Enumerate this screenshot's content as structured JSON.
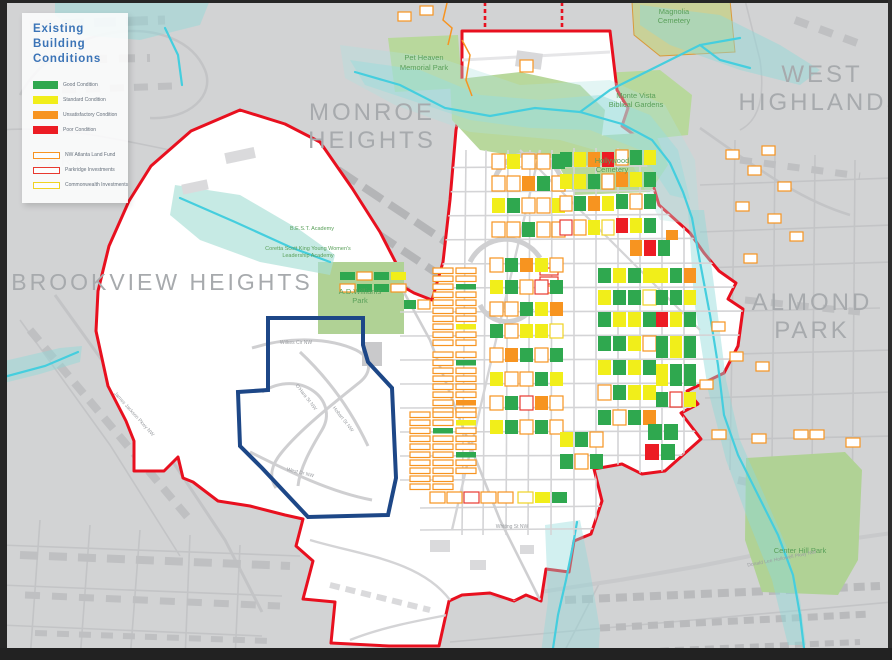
{
  "legend": {
    "title_lines": [
      "Existing",
      "Building",
      "Conditions"
    ],
    "condition_items": [
      {
        "label": "Good Condition",
        "color": "#2fa84f"
      },
      {
        "label": "Standard Condition",
        "color": "#f1ee1a"
      },
      {
        "label": "Unsatisfactory Condition",
        "color": "#f79420"
      },
      {
        "label": "Poor Condition",
        "color": "#ec1c24"
      }
    ],
    "ownership_items": [
      {
        "label": "NW Atlanta Land Fund",
        "outline": "#f79420"
      },
      {
        "label": "Parkridge Investments",
        "outline": "#e8392f"
      },
      {
        "label": "Commonwealth Investments",
        "outline": "#f0d322"
      }
    ]
  },
  "neighborhood_labels": {
    "monroe": {
      "line1": "MONROE",
      "line2": "HEIGHTS"
    },
    "west_highlands": {
      "line1": "WEST",
      "line2": "HIGHLANDS"
    },
    "brookview": {
      "line1": "BROOKVIEW HEIGHTS"
    },
    "almond": {
      "line1": "ALMOND",
      "line2": "PARK"
    },
    "park_partial": {
      "line1": "PARK"
    }
  },
  "park_labels": {
    "pet_heaven": {
      "line1": "Pet Heaven",
      "line2": "Memorial Park"
    },
    "magnolia": {
      "line1": "Magnolia",
      "line2": "Cemetery"
    },
    "monte_vista": {
      "line1": "Monte Vista",
      "line2": "Biblical Gardens"
    },
    "hollywood": {
      "line1": "Hollywood",
      "line2": "Cemetery"
    },
    "adw": {
      "line1": "A.D.Williams",
      "line2": "Park"
    },
    "center_hill": {
      "line1": "Center Hill Park"
    }
  },
  "school_labels": {
    "best": "B.E.S.T. Academy",
    "coretta1": "Coretta Scott King Young Women's",
    "coretta2": "Leadership Academy"
  },
  "street_labels": {
    "wilkes": "Wilkes Cir NW",
    "ohara": "O'Hara St NW",
    "hobart": "Hobart St NW",
    "west_dr": "West Dr NW",
    "whiting": "Whiting St NW",
    "dlh": "Donald Lee Hollowell Pkwy NW",
    "james_jackson": "James Jackson Pkwy NW"
  },
  "colors": {
    "map_background": "#d2d3d4",
    "study_area_fill": "#ffffff",
    "study_boundary_red": "#e8101f",
    "focus_outline_navy": "#1d4787",
    "park_green": "#b8d89c",
    "creek_cyan": "#45cede",
    "floodplain_teal": "#8fd9da",
    "neighborhood_label_gray": "#a7aaad",
    "park_label_green": "#5aa05a",
    "legend_title_blue": "#3b74b7"
  },
  "parcels": {
    "palette": {
      "g": {
        "fill": "#2fa84f"
      },
      "y": {
        "fill": "#f1ee1a"
      },
      "o": {
        "fill": "#f79420"
      },
      "r": {
        "fill": "#ec1c24"
      },
      "w": {
        "fill": "#ffffff",
        "stroke": "#f79420"
      },
      "p": {
        "fill": "#ffffff",
        "stroke": "#e8392f"
      },
      "c": {
        "fill": "#ffffff",
        "stroke": "#f0d322"
      },
      "b": {
        "fill": "#ffffff",
        "stroke": "#bdbdbf"
      }
    },
    "blocks": [
      {
        "x": 433,
        "y": 268,
        "cw": 20,
        "ch": 5.5,
        "gy": 2.5,
        "dir": "v",
        "cells": "wwwwwwwwww"
      },
      {
        "x": 456,
        "y": 268,
        "cw": 20,
        "ch": 5.5,
        "gy": 2.5,
        "dir": "v",
        "cells": "wwgwwwwyww"
      },
      {
        "x": 433,
        "y": 352,
        "cw": 20,
        "ch": 5.5,
        "gy": 2.5,
        "dir": "v",
        "cells": "wwwwwwww"
      },
      {
        "x": 456,
        "y": 352,
        "cw": 20,
        "ch": 5.5,
        "gy": 2.5,
        "dir": "v",
        "cells": "wgwwwwow"
      },
      {
        "x": 410,
        "y": 412,
        "cw": 20,
        "ch": 5.5,
        "gy": 2.5,
        "dir": "v",
        "cells": "wwwwwwwwww"
      },
      {
        "x": 433,
        "y": 412,
        "cw": 20,
        "ch": 5.5,
        "gy": 2.5,
        "dir": "v",
        "cells": "wwgwwwwwww"
      },
      {
        "x": 456,
        "y": 412,
        "cw": 20,
        "ch": 5.5,
        "gy": 2.5,
        "dir": "v",
        "cells": "wywwwgww"
      },
      {
        "x": 340,
        "y": 272,
        "cw": 15,
        "ch": 8,
        "dir": "h",
        "cells": "gwgy"
      },
      {
        "x": 340,
        "y": 284,
        "cw": 15,
        "ch": 8,
        "dir": "h",
        "cells": "wggw"
      },
      {
        "x": 404,
        "y": 300,
        "cw": 12,
        "ch": 9,
        "dir": "h",
        "cells": "gw"
      },
      {
        "x": 492,
        "y": 154,
        "cw": 13,
        "ch": 15,
        "dir": "h",
        "cells": "wywwg"
      },
      {
        "x": 492,
        "y": 176,
        "cw": 13,
        "ch": 15,
        "dir": "h",
        "cells": "wwogw"
      },
      {
        "x": 492,
        "y": 198,
        "cw": 13,
        "ch": 15,
        "dir": "h",
        "cells": "ygwwy"
      },
      {
        "x": 492,
        "y": 222,
        "cw": 13,
        "ch": 15,
        "dir": "h",
        "cells": "wwgww"
      },
      {
        "x": 560,
        "y": 152,
        "cw": 12,
        "ch": 15,
        "dir": "h",
        "cells": "gyor"
      },
      {
        "x": 560,
        "y": 174,
        "cw": 12,
        "ch": 15,
        "dir": "h",
        "cells": "yygw"
      },
      {
        "x": 560,
        "y": 196,
        "cw": 12,
        "ch": 15,
        "dir": "h",
        "cells": "wgoy"
      },
      {
        "x": 616,
        "y": 150,
        "cw": 12,
        "ch": 15,
        "dir": "h",
        "cells": "wgy"
      },
      {
        "x": 616,
        "y": 172,
        "cw": 12,
        "ch": 15,
        "dir": "h",
        "cells": "oyg"
      },
      {
        "x": 616,
        "y": 194,
        "cw": 12,
        "ch": 15,
        "dir": "h",
        "cells": "gwg"
      },
      {
        "x": 560,
        "y": 220,
        "cw": 12,
        "ch": 15,
        "dir": "h",
        "cells": "pwyc"
      },
      {
        "x": 616,
        "y": 218,
        "cw": 12,
        "ch": 15,
        "dir": "h",
        "cells": "ryg"
      },
      {
        "x": 630,
        "y": 240,
        "cw": 12,
        "ch": 16,
        "dir": "h",
        "cells": "org"
      },
      {
        "x": 540,
        "y": 268,
        "cw": 18,
        "ch": 7,
        "gy": 2,
        "dir": "v",
        "cells": "ppw"
      },
      {
        "x": 490,
        "y": 258,
        "cw": 13,
        "ch": 14,
        "dir": "h",
        "cells": "wgoyw"
      },
      {
        "x": 490,
        "y": 280,
        "cw": 13,
        "ch": 14,
        "dir": "h",
        "cells": "ygwpg"
      },
      {
        "x": 490,
        "y": 302,
        "cw": 13,
        "ch": 14,
        "dir": "h",
        "cells": "wwgyo"
      },
      {
        "x": 490,
        "y": 324,
        "cw": 13,
        "ch": 14,
        "dir": "h",
        "cells": "gwyyc"
      },
      {
        "x": 490,
        "y": 348,
        "cw": 13,
        "ch": 14,
        "dir": "h",
        "cells": "wogwg"
      },
      {
        "x": 490,
        "y": 372,
        "cw": 13,
        "ch": 14,
        "dir": "h",
        "cells": "ywwgy"
      },
      {
        "x": 490,
        "y": 396,
        "cw": 13,
        "ch": 14,
        "dir": "h",
        "cells": "wgpow"
      },
      {
        "x": 490,
        "y": 420,
        "cw": 13,
        "ch": 14,
        "dir": "h",
        "cells": "ygwgw"
      },
      {
        "x": 598,
        "y": 268,
        "cw": 13,
        "ch": 15,
        "dir": "h",
        "cells": "gygy"
      },
      {
        "x": 598,
        "y": 290,
        "cw": 13,
        "ch": 15,
        "dir": "h",
        "cells": "yggc"
      },
      {
        "x": 598,
        "y": 312,
        "cw": 13,
        "ch": 15,
        "dir": "h",
        "cells": "gyyg"
      },
      {
        "x": 656,
        "y": 268,
        "cw": 12,
        "ch": 15,
        "dir": "h",
        "cells": "ygo"
      },
      {
        "x": 656,
        "y": 290,
        "cw": 12,
        "ch": 15,
        "dir": "h",
        "cells": "ggy"
      },
      {
        "x": 656,
        "y": 312,
        "cw": 12,
        "ch": 15,
        "dir": "h",
        "cells": "ryg"
      },
      {
        "x": 598,
        "y": 336,
        "cw": 13,
        "ch": 15,
        "dir": "h",
        "cells": "ggyw"
      },
      {
        "x": 598,
        "y": 360,
        "cw": 13,
        "ch": 15,
        "dir": "h",
        "cells": "ygyg"
      },
      {
        "x": 656,
        "y": 336,
        "cw": 12,
        "ch": 22,
        "dir": "h",
        "cells": "gyg"
      },
      {
        "x": 656,
        "y": 364,
        "cw": 12,
        "ch": 22,
        "dir": "h",
        "cells": "ygg"
      },
      {
        "x": 598,
        "y": 385,
        "cw": 13,
        "ch": 15,
        "dir": "h",
        "cells": "wgyy"
      },
      {
        "x": 598,
        "y": 410,
        "cw": 13,
        "ch": 15,
        "dir": "h",
        "cells": "gwgo"
      },
      {
        "x": 656,
        "y": 392,
        "cw": 12,
        "ch": 15,
        "dir": "h",
        "cells": "gpy"
      },
      {
        "x": 560,
        "y": 432,
        "cw": 13,
        "ch": 15,
        "dir": "h",
        "cells": "ygw"
      },
      {
        "x": 560,
        "y": 454,
        "cw": 13,
        "ch": 15,
        "dir": "h",
        "cells": "gwg"
      },
      {
        "x": 648,
        "y": 424,
        "cw": 14,
        "ch": 16,
        "dir": "h",
        "cells": "gg"
      },
      {
        "x": 645,
        "y": 444,
        "cw": 14,
        "ch": 16,
        "dir": "h",
        "cells": "rg"
      },
      {
        "x": 430,
        "y": 492,
        "cw": 15,
        "ch": 11,
        "dir": "h",
        "cells": "wwpww"
      },
      {
        "x": 518,
        "y": 492,
        "cw": 15,
        "ch": 11,
        "dir": "h",
        "cells": "cyg"
      },
      {
        "x": 520,
        "y": 60,
        "cw": 13,
        "ch": 12,
        "dir": "h",
        "cells": "w"
      },
      {
        "x": 666,
        "y": 230,
        "cw": 12,
        "ch": 10,
        "dir": "h",
        "cells": "o"
      },
      {
        "x": 726,
        "y": 150,
        "cw": 13,
        "ch": 9,
        "dir": "h",
        "cells": "w"
      },
      {
        "x": 748,
        "y": 166,
        "cw": 13,
        "ch": 9,
        "dir": "h",
        "cells": "w"
      },
      {
        "x": 762,
        "y": 146,
        "cw": 13,
        "ch": 9,
        "dir": "h",
        "cells": "w"
      },
      {
        "x": 778,
        "y": 182,
        "cw": 13,
        "ch": 9,
        "dir": "h",
        "cells": "w"
      },
      {
        "x": 736,
        "y": 202,
        "cw": 13,
        "ch": 9,
        "dir": "h",
        "cells": "w"
      },
      {
        "x": 768,
        "y": 214,
        "cw": 13,
        "ch": 9,
        "dir": "h",
        "cells": "w"
      },
      {
        "x": 790,
        "y": 232,
        "cw": 13,
        "ch": 9,
        "dir": "h",
        "cells": "w"
      },
      {
        "x": 744,
        "y": 254,
        "cw": 13,
        "ch": 9,
        "dir": "h",
        "cells": "w"
      },
      {
        "x": 712,
        "y": 322,
        "cw": 13,
        "ch": 9,
        "dir": "h",
        "cells": "w"
      },
      {
        "x": 730,
        "y": 352,
        "cw": 13,
        "ch": 9,
        "dir": "h",
        "cells": "w"
      },
      {
        "x": 700,
        "y": 380,
        "cw": 13,
        "ch": 9,
        "dir": "h",
        "cells": "w"
      },
      {
        "x": 756,
        "y": 362,
        "cw": 13,
        "ch": 9,
        "dir": "h",
        "cells": "w"
      },
      {
        "x": 712,
        "y": 430,
        "cw": 14,
        "ch": 9,
        "dir": "h",
        "cells": "w"
      },
      {
        "x": 752,
        "y": 434,
        "cw": 14,
        "ch": 9,
        "dir": "h",
        "cells": "w"
      },
      {
        "x": 794,
        "y": 430,
        "cw": 14,
        "ch": 9,
        "dir": "h",
        "cells": "ww"
      },
      {
        "x": 846,
        "y": 438,
        "cw": 14,
        "ch": 9,
        "dir": "h",
        "cells": "w"
      },
      {
        "x": 398,
        "y": 12,
        "cw": 13,
        "ch": 9,
        "dir": "h",
        "cells": "w"
      },
      {
        "x": 420,
        "y": 6,
        "cw": 13,
        "ch": 9,
        "dir": "h",
        "cells": "w"
      }
    ]
  }
}
